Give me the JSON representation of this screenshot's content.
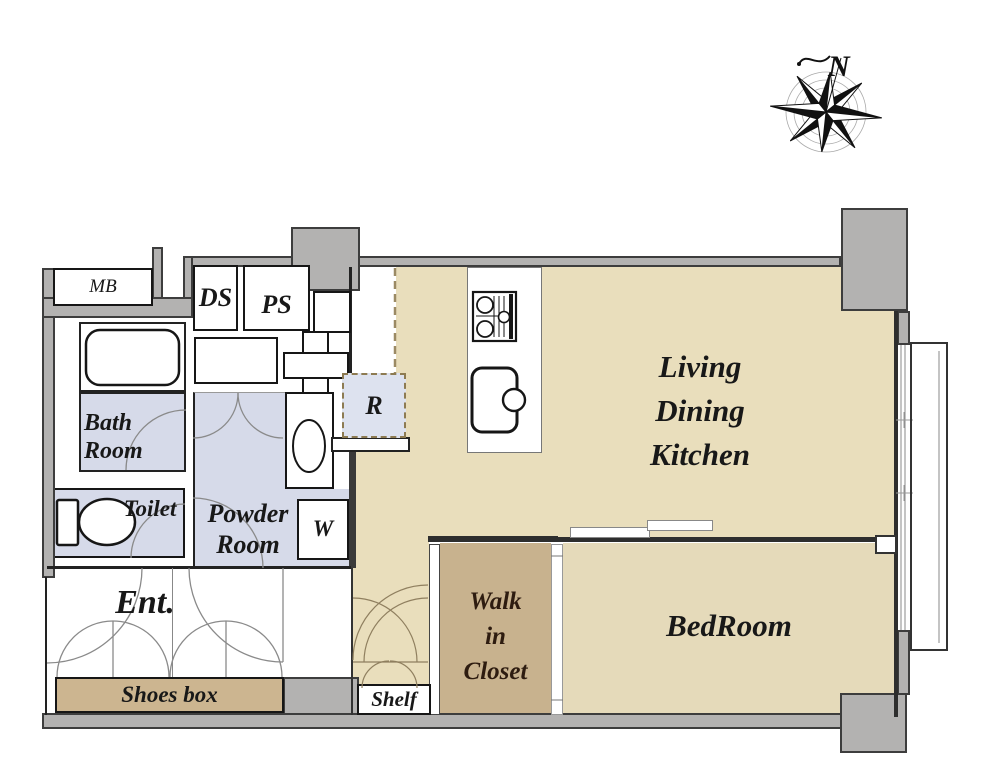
{
  "title": "1LDK apartment floor plan",
  "compass": {
    "label": "N"
  },
  "colors": {
    "wall_gray": "#b3b2b1",
    "wall_outline": "#3d3d3d",
    "ldk_floor": "#e9debc",
    "bedroom_floor": "#e5daba",
    "closet_floor": "#c8b28e",
    "shoesbox_fill": "#ccb590",
    "wet_area": "#d6dae9",
    "appliance_fill": "#dde2ef",
    "dashed_line": "#9b8a64",
    "ink": "#181818"
  },
  "rooms": {
    "ldk": {
      "lines": [
        "Living",
        "Dining",
        "Kitchen"
      ]
    },
    "bedroom": {
      "label": "BedRoom"
    },
    "wic": {
      "lines": [
        "Walk",
        "in",
        "Closet"
      ]
    },
    "ent": {
      "label": "Ent."
    },
    "powder": {
      "lines": [
        "Powder",
        "Room"
      ]
    },
    "bath": {
      "lines": [
        "Bath",
        "Room"
      ]
    },
    "toilet": {
      "label": "Toilet"
    },
    "shoesbox": {
      "label": "Shoes box"
    },
    "shelf": {
      "label": "Shelf"
    },
    "mb": {
      "label": "MB"
    },
    "ds": {
      "label": "DS"
    },
    "ps": {
      "label": "PS"
    },
    "fridge": {
      "label": "R"
    },
    "washer": {
      "label": "W"
    }
  }
}
